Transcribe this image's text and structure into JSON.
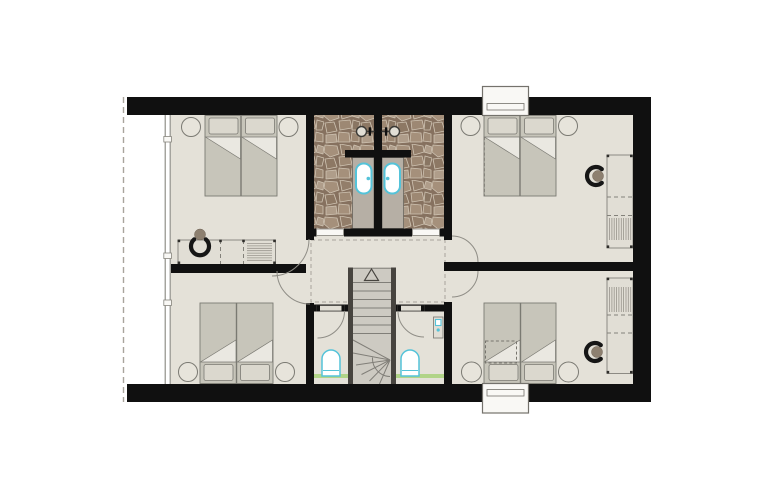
{
  "canvas": {
    "width": 771,
    "height": 500
  },
  "plan": {
    "type": "architectural-floor-plan",
    "storey": "upper floor",
    "rooms": [
      {
        "name": "bedroom-top-left",
        "features": [
          "double-bed",
          "two-nightstands",
          "desk",
          "chair"
        ]
      },
      {
        "name": "bedroom-top-right",
        "features": [
          "double-bed",
          "two-nightstands",
          "desk",
          "chair",
          "dormer-window"
        ]
      },
      {
        "name": "bedroom-bottom-left",
        "features": [
          "double-bed",
          "two-nightstands"
        ]
      },
      {
        "name": "bedroom-bottom-right",
        "features": [
          "double-bed",
          "two-nightstands",
          "desk",
          "chair",
          "dormer-window"
        ]
      },
      {
        "name": "shower-room-left",
        "features": [
          "stone-floor",
          "shower-head",
          "vanity-washbasin",
          "sliding-door"
        ]
      },
      {
        "name": "shower-room-right",
        "features": [
          "stone-floor",
          "shower-head",
          "vanity-washbasin",
          "sliding-door"
        ]
      },
      {
        "name": "wc-left",
        "features": [
          "toilet"
        ]
      },
      {
        "name": "wc-right",
        "features": [
          "toilet",
          "hand-basin"
        ]
      },
      {
        "name": "hallway",
        "features": [
          "dashed-ceiling-line"
        ]
      },
      {
        "name": "staircase",
        "features": [
          "winder-stairs",
          "up-arrow"
        ]
      }
    ],
    "facade_left": "glazed wall with roof overhang dashed line"
  },
  "colors": {
    "wall": "#101010",
    "floor": "#e4e1d8",
    "outline": "#83817a",
    "furniture": "#e1ded5",
    "mattress": "#c7c5ba",
    "pillow": "#dbd8ce",
    "fold": "#eae8e1",
    "vanity": "#b6afa5",
    "teal": "#54c3d9",
    "green": "#abd37f",
    "stairFill": "#cdcac2",
    "stairDark": "#47443f",
    "stairLine": "#807e78",
    "chair": "#161616",
    "chairSeat": "#8d8070",
    "dash": "#a8a49c",
    "glass": "#87857e",
    "white": "#f9f8f5",
    "bedLine": "#7b7a73",
    "legs": "#2f2e2b",
    "fixtureDark": "#3a3935",
    "stoneBase": "#86715f",
    "stoneA": "#a5907b",
    "stoneB": "#937e6a",
    "stoneC": "#af9d8a",
    "stoneD": "#8d7864",
    "stoneE": "#9d8873",
    "stoneF": "#897663",
    "stoneGap": "#cfc3b2"
  }
}
